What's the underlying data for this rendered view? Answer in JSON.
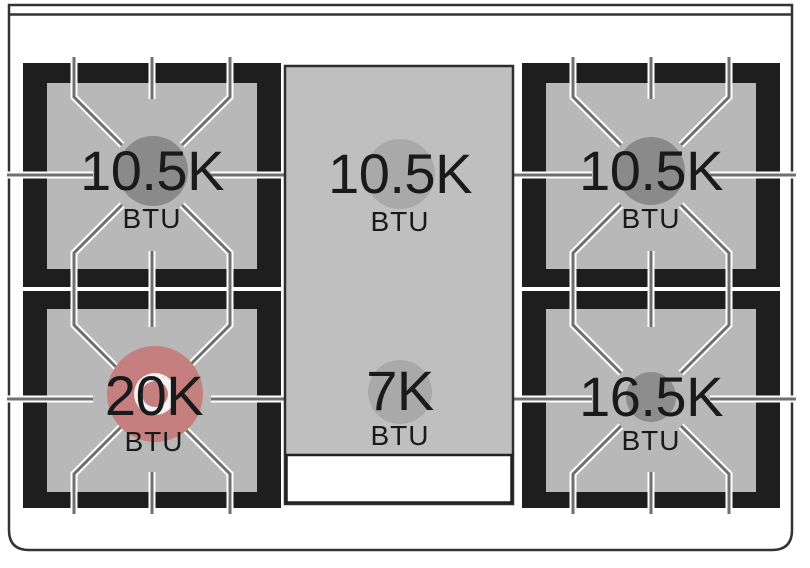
{
  "burners": [
    {
      "position": "top-left",
      "value": "10.5K",
      "unit": "BTU",
      "cap_color": "#8a8a8a"
    },
    {
      "position": "top-center",
      "value": "10.5K",
      "unit": "BTU",
      "cap_color": "#a9a9a9"
    },
    {
      "position": "top-right",
      "value": "10.5K",
      "unit": "BTU",
      "cap_color": "#8a8a8a"
    },
    {
      "position": "bottom-left",
      "value": "20K",
      "unit": "BTU",
      "cap_color": "#c67f7f"
    },
    {
      "position": "bottom-center",
      "value": "7K",
      "unit": "BTU",
      "cap_color": "#a9a9a9"
    },
    {
      "position": "bottom-right",
      "value": "16.5K",
      "unit": "BTU",
      "cap_color": "#8d8d8d"
    }
  ],
  "colors": {
    "background": "#ffffff",
    "frame_line": "#333333",
    "grate_black": "#1e1e1e",
    "burner_well_gray": "#b8b8b8",
    "griddle_panel_gray": "#bfbfbf",
    "grate_line_gray": "#6f6f6f",
    "grate_line_casing": "#ffffff",
    "dual_ring_white": "#f2f2f2",
    "highlight_red": "#c67f7f",
    "text": "#1a1a1a"
  }
}
